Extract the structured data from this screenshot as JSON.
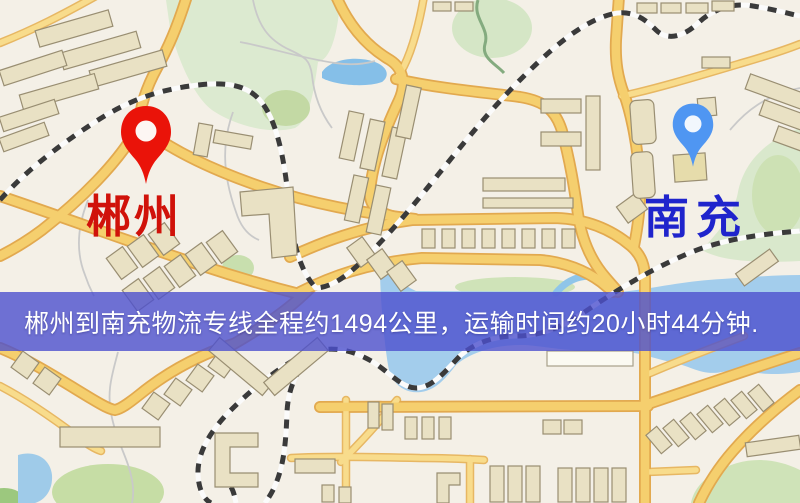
{
  "map": {
    "origin": {
      "name": "郴州",
      "marker_color": "#ea1309",
      "label_color": "#d0120a"
    },
    "destination": {
      "name": "南充",
      "marker_color": "#4f96f2",
      "label_color": "#1f24cc"
    },
    "banner": {
      "text": "郴州到南充物流专线全程约1494公里，运输时间约20小时44分钟.",
      "background": "#4c50ce",
      "text_color": "#ffffff"
    },
    "icons": {
      "origin": "red-map-pin-icon",
      "destination": "blue-map-pin-icon"
    },
    "palette": {
      "land": "#f4f0e7",
      "road_fill": "#f5cf6e",
      "road_casing": "#e2a94f",
      "park": "#dcead0",
      "water": "#a3cdec",
      "building": "#e9e1c4",
      "building_outline": "#998e72",
      "railway": "#3a3a3a"
    }
  }
}
